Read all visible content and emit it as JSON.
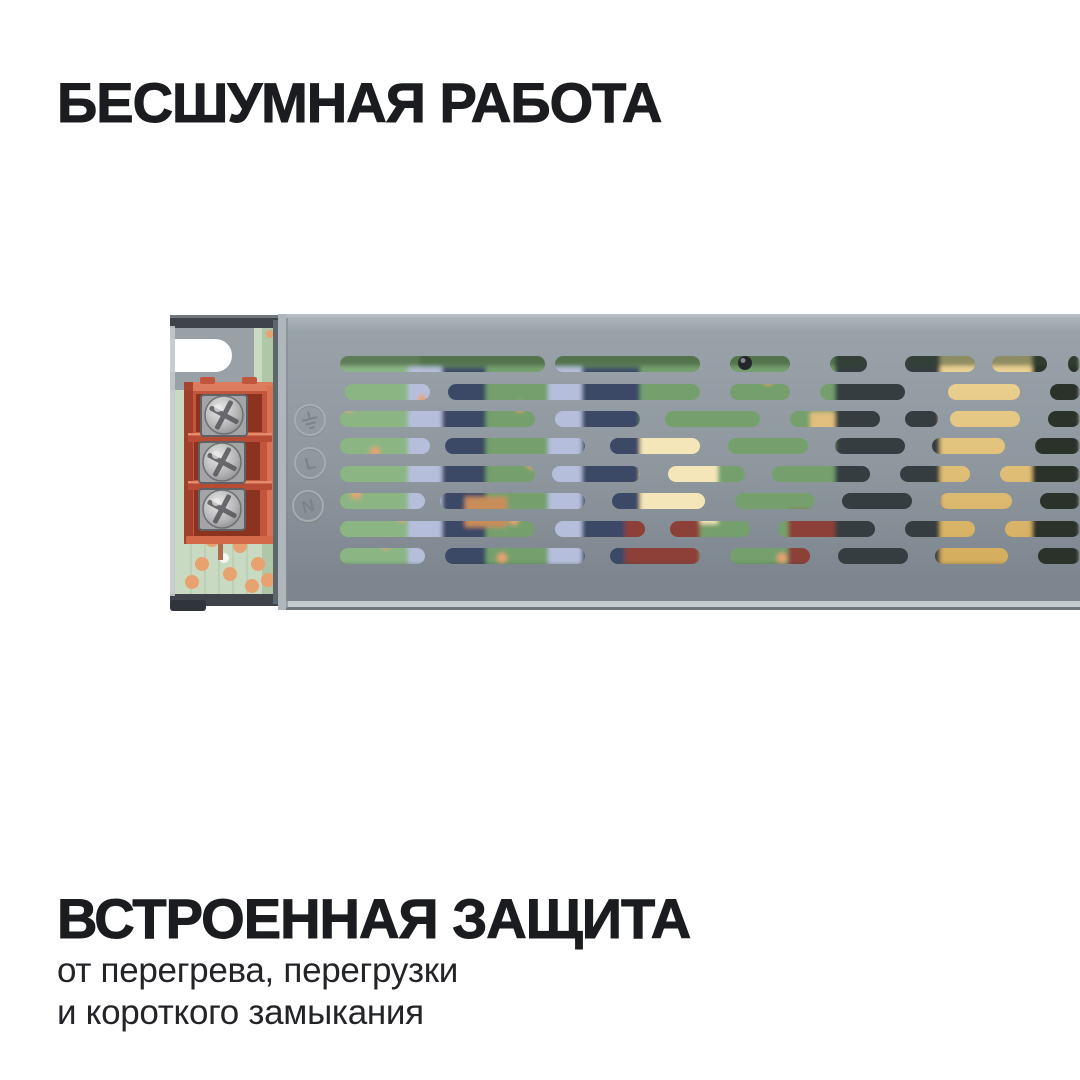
{
  "card": {
    "background": "#ffffff",
    "text_color": "#1b1c1f",
    "subtitle_color": "#232428"
  },
  "top_title": {
    "text": "БЕСШУМНАЯ РАБОТА"
  },
  "bottom_title": {
    "text": "ВСТРОЕННАЯ ЗАЩИТА"
  },
  "bottom_subtitle": {
    "line1": "от перегрева, перегрузки",
    "line2": "и короткого замыкания"
  },
  "device": {
    "description": "led-driver-power-supply-photo-cropped-at-right-edge",
    "colors": {
      "cover_top": "#b2b8bd",
      "cover_upper": "#9aa2a9",
      "cover_face": "#8f979f",
      "cover_face_dark": "#7d868e",
      "cover_bottom_rim": "#c6cbce",
      "cover_edge_dark": "#6f777e",
      "chassis_dark": "#3e444a",
      "flange": "#99a0a6",
      "pcb_light": "#c9dac2",
      "pcb_shade": "#a9c2a0",
      "pad_orange": "#e8a270",
      "terminal_body": "#c2563d",
      "terminal_light": "#dd7b5f",
      "terminal_dark": "#9c3b27",
      "terminal_cavity": "#8c3320",
      "terminal_divider": "#b84b33",
      "terminal_divider_hl": "#e58a6d",
      "screw_metal": "#b5b5b6",
      "screw_metal_dark": "#7d7d7f",
      "screw_slot": "#55565a",
      "emboss_light": "#a9b0b6",
      "emboss_dark": "#767f87",
      "marking": "#79828a",
      "interior_green": "#75a06d",
      "interior_green_light": "#8cb584",
      "interior_green_dark": "#2f4630",
      "cap_light": "#b5bfdc",
      "cap_navy": "#3a4866",
      "transformer_cream": "#f4e6b8",
      "comp_red": "#8c4038",
      "comp_tan": "#c98d5a",
      "comp_dark": "#363c40",
      "toroid_gold_light": "#eed598",
      "toroid_gold": "#d2a958",
      "right_dark": "#2a322c"
    },
    "terminal_markings": [
      "earth-ground",
      "L",
      "N"
    ],
    "terminal_screws": 3,
    "screw_positions": [
      [
        54,
        103
      ],
      [
        52,
        150
      ],
      [
        52,
        197
      ]
    ],
    "pcb_pads": [
      [
        32,
        252
      ],
      [
        60,
        262
      ],
      [
        88,
        252
      ],
      [
        42,
        228
      ],
      [
        98,
        268
      ],
      [
        70,
        234
      ],
      [
        22,
        270
      ],
      [
        82,
        274
      ],
      [
        100,
        22,
        4
      ]
    ],
    "vent_slot_rows": [
      {
        "y": 44,
        "slots": [
          [
            170,
            375
          ],
          [
            385,
            530
          ],
          [
            560,
            620
          ],
          [
            660,
            697
          ],
          [
            735,
            805
          ],
          [
            822,
            877
          ],
          [
            898,
            910
          ]
        ]
      },
      {
        "y": 72,
        "slots": [
          [
            175,
            260
          ],
          [
            278,
            530
          ],
          [
            560,
            620
          ],
          [
            650,
            735
          ],
          [
            778,
            850
          ],
          [
            880,
            910
          ]
        ]
      },
      {
        "y": 99,
        "slots": [
          [
            170,
            365
          ],
          [
            385,
            470
          ],
          [
            495,
            590
          ],
          [
            620,
            710
          ],
          [
            735,
            768
          ],
          [
            780,
            850
          ],
          [
            878,
            910
          ]
        ]
      },
      {
        "y": 126,
        "slots": [
          [
            170,
            260
          ],
          [
            275,
            415
          ],
          [
            440,
            530
          ],
          [
            558,
            638
          ],
          [
            665,
            735
          ],
          [
            762,
            835
          ],
          [
            865,
            910
          ]
        ]
      },
      {
        "y": 154,
        "slots": [
          [
            170,
            365
          ],
          [
            382,
            470
          ],
          [
            498,
            575
          ],
          [
            602,
            700
          ],
          [
            730,
            800
          ],
          [
            830,
            910
          ]
        ]
      },
      {
        "y": 181,
        "slots": [
          [
            170,
            255
          ],
          [
            270,
            415
          ],
          [
            442,
            535
          ],
          [
            565,
            645
          ],
          [
            672,
            742
          ],
          [
            770,
            842
          ],
          [
            870,
            910
          ]
        ]
      },
      {
        "y": 209,
        "slots": [
          [
            170,
            365
          ],
          [
            385,
            475
          ],
          [
            500,
            580
          ],
          [
            608,
            705
          ],
          [
            735,
            805
          ],
          [
            835,
            910
          ]
        ]
      },
      {
        "y": 236,
        "slots": [
          [
            170,
            255
          ],
          [
            275,
            415
          ],
          [
            440,
            530
          ],
          [
            560,
            640
          ],
          [
            668,
            738
          ],
          [
            765,
            838
          ],
          [
            868,
            910
          ]
        ]
      }
    ],
    "interior_components": [
      {
        "name": "pcb-base",
        "x": 160,
        "y": 38,
        "w": 750,
        "h": 232,
        "fill": "interior_green"
      },
      {
        "name": "pcb-left-light",
        "x": 160,
        "y": 38,
        "w": 90,
        "h": 232,
        "fill": "interior_green_light"
      },
      {
        "name": "capacitor-a-highlight",
        "x": 238,
        "y": 55,
        "w": 34,
        "h": 210,
        "fill": "cap_light"
      },
      {
        "name": "capacitor-a-body",
        "x": 272,
        "y": 55,
        "w": 44,
        "h": 210,
        "fill": "cap_navy"
      },
      {
        "name": "capacitor-b-highlight",
        "x": 378,
        "y": 55,
        "w": 34,
        "h": 210,
        "fill": "cap_light"
      },
      {
        "name": "capacitor-b-body",
        "x": 412,
        "y": 55,
        "w": 58,
        "h": 210,
        "fill": "cap_navy"
      },
      {
        "name": "transformer-cream",
        "x": 470,
        "y": 120,
        "w": 78,
        "h": 92,
        "fill": "transformer_cream"
      },
      {
        "name": "inductor-gold-bar",
        "x": 640,
        "y": 100,
        "w": 138,
        "h": 22,
        "fill": "#e2bf7f"
      },
      {
        "name": "component-tan",
        "x": 295,
        "y": 185,
        "w": 42,
        "h": 30,
        "fill": "comp_tan"
      },
      {
        "name": "capacitor-red-a",
        "x": 455,
        "y": 205,
        "w": 75,
        "h": 50,
        "fill": "comp_red"
      },
      {
        "name": "capacitor-red-b",
        "x": 618,
        "y": 198,
        "w": 112,
        "h": 58,
        "fill": "comp_red"
      },
      {
        "name": "components-dark",
        "x": 665,
        "y": 38,
        "w": 112,
        "h": 232,
        "fill": "comp_dark"
      },
      {
        "name": "toroid-gold",
        "x": 770,
        "y": 38,
        "w": 95,
        "h": 232,
        "fill": "gold-gradient"
      },
      {
        "name": "right-dark",
        "x": 862,
        "y": 38,
        "w": 48,
        "h": 232,
        "fill": "right_dark"
      },
      {
        "name": "shade-top",
        "x": 160,
        "y": 38,
        "w": 750,
        "h": 16,
        "fill": "interior_green_dark",
        "opacity": 0.5
      },
      {
        "name": "shade-bottom",
        "x": 160,
        "y": 252,
        "w": 750,
        "h": 18,
        "fill": "interior_green_dark",
        "opacity": 0.45
      }
    ],
    "interior_pads": [
      [
        178,
        95
      ],
      [
        205,
        140
      ],
      [
        186,
        182
      ],
      [
        216,
        232
      ],
      [
        252,
        88
      ],
      [
        232,
        205
      ],
      [
        350,
        95
      ],
      [
        362,
        152
      ],
      [
        344,
        208
      ],
      [
        332,
        246
      ],
      [
        598,
        68
      ],
      [
        612,
        246
      ],
      [
        582,
        160
      ]
    ]
  }
}
